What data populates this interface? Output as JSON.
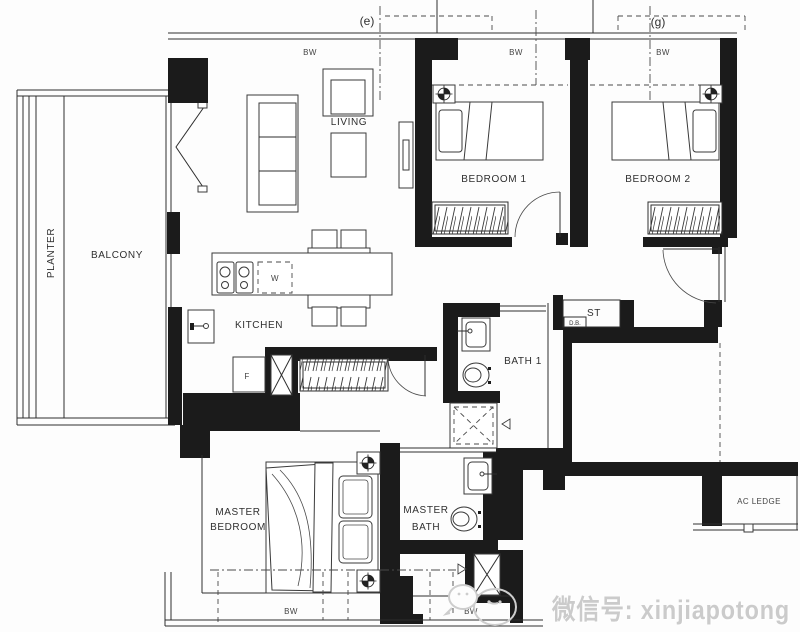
{
  "title": "apartment-floor-plan",
  "colors": {
    "wall": "#1b1b1b",
    "line": "#2e2e2e",
    "background": "#fdfdfd",
    "watermark": "#cbcbcb"
  },
  "grid": {
    "e": "(e)",
    "g": "(g)"
  },
  "rooms": {
    "planter": "PLANTER",
    "balcony": "BALCONY",
    "living": "LIVING",
    "dining": "DINING",
    "kitchen": "KITCHEN",
    "bedroom1": "BEDROOM 1",
    "bedroom2": "BEDROOM 2",
    "bath1": "BATH 1",
    "master_bedroom": {
      "line1": "MASTER",
      "line2": "BEDROOM"
    },
    "master_bath": {
      "line1": "MASTER",
      "line2": "BATH"
    },
    "store": "ST",
    "db": "D.B.",
    "ac_ledge": "AC LEDGE"
  },
  "appliances": {
    "fridge": "F",
    "washer": "W"
  },
  "annotations": {
    "bw": [
      "BW",
      "BW",
      "BW",
      "BW",
      "BW"
    ]
  },
  "watermark": {
    "text": "微信号: xinjiapotong"
  }
}
